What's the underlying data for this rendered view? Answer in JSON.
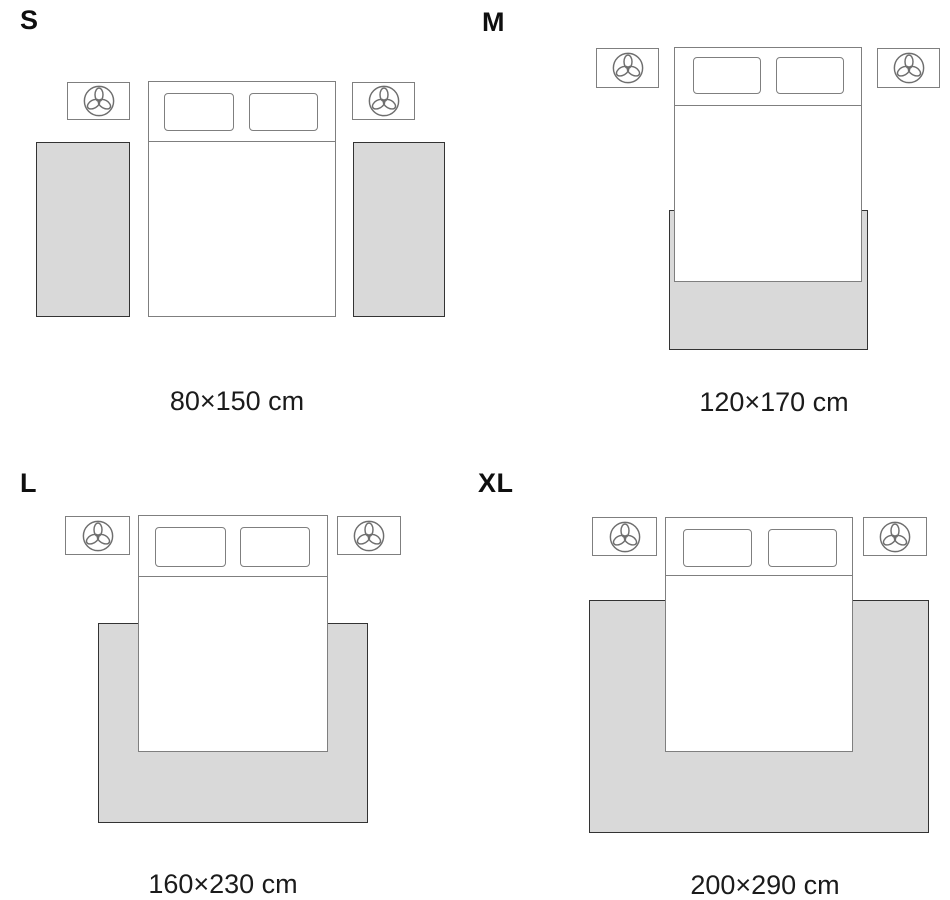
{
  "colors": {
    "background": "#ffffff",
    "rug_fill": "#d9d9d9",
    "rug_border": "#333333",
    "furniture_border": "#7f7f7f",
    "text": "#1b1b1b"
  },
  "icons": {
    "nightstand_icon": "plant-icon"
  },
  "sizes": [
    {
      "id": "s",
      "label": "S",
      "caption": "80×150 cm"
    },
    {
      "id": "m",
      "label": "M",
      "caption": "120×170 cm"
    },
    {
      "id": "l",
      "label": "L",
      "caption": "160×230 cm"
    },
    {
      "id": "xl",
      "label": "XL",
      "caption": "200×290 cm"
    }
  ]
}
